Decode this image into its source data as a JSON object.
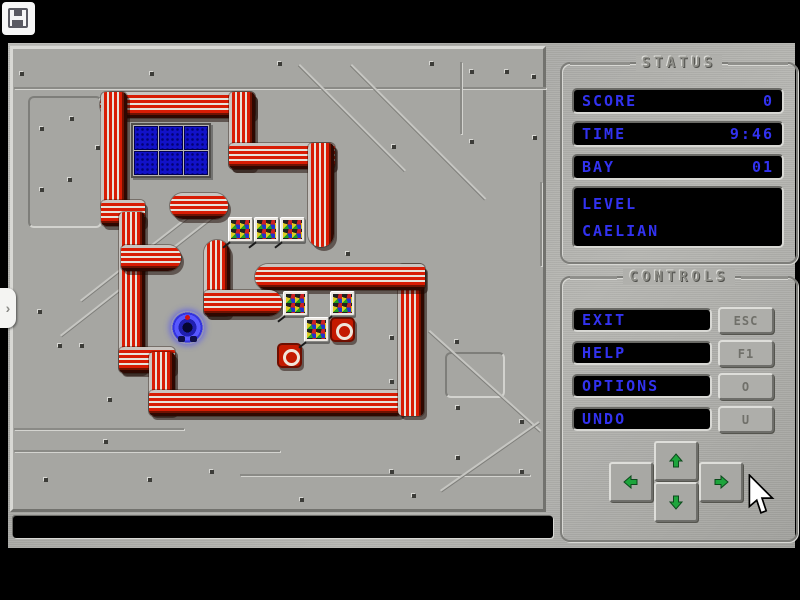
{
  "save_button": {
    "icon": "floppy-disk-icon"
  },
  "side_tab": {
    "chevron": "›"
  },
  "status_panel": {
    "title": "STATUS",
    "rows": [
      {
        "label": "SCORE",
        "value": "0"
      },
      {
        "label": "TIME",
        "value": "9:46"
      },
      {
        "label": "BAY",
        "value": "01"
      }
    ],
    "level_label": "LEVEL",
    "level_name": "CAELIAN"
  },
  "controls_panel": {
    "title": "CONTROLS",
    "buttons": [
      {
        "label": "EXIT",
        "key": "ESC"
      },
      {
        "label": "HELP",
        "key": "F1"
      },
      {
        "label": "OPTIONS",
        "key": "O"
      },
      {
        "label": "UNDO",
        "key": "U"
      }
    ],
    "dpad": [
      "up",
      "left",
      "down",
      "right"
    ]
  },
  "message_bar": {
    "text": ""
  },
  "colors": {
    "lcd_text": "#3232f0",
    "wall_red": "#d81c04",
    "arrow_green": "#1da53c",
    "water_blue": "#1212c8",
    "target_red": "#c41a00",
    "metal": "#b0b0ac"
  },
  "level": {
    "walls": [
      {
        "x": 100,
        "y": 92,
        "w": 155,
        "h": 26,
        "dir": "h",
        "cap": "left"
      },
      {
        "x": 229,
        "y": 92,
        "w": 26,
        "h": 77,
        "dir": "v",
        "cap": "none"
      },
      {
        "x": 229,
        "y": 143,
        "w": 106,
        "h": 26,
        "dir": "h",
        "cap": "none"
      },
      {
        "x": 308,
        "y": 143,
        "w": 26,
        "h": 104,
        "dir": "v",
        "cap": "bottom"
      },
      {
        "x": 101,
        "y": 92,
        "w": 26,
        "h": 120,
        "dir": "v",
        "cap": "none"
      },
      {
        "x": 101,
        "y": 200,
        "w": 44,
        "h": 26,
        "dir": "h",
        "cap": "none"
      },
      {
        "x": 119,
        "y": 212,
        "w": 26,
        "h": 160,
        "dir": "v",
        "cap": "none"
      },
      {
        "x": 121,
        "y": 245,
        "w": 60,
        "h": 26,
        "dir": "h",
        "cap": "right"
      },
      {
        "x": 119,
        "y": 347,
        "w": 56,
        "h": 26,
        "dir": "h",
        "cap": "none"
      },
      {
        "x": 149,
        "y": 352,
        "w": 26,
        "h": 62,
        "dir": "v",
        "cap": "none"
      },
      {
        "x": 149,
        "y": 390,
        "w": 253,
        "h": 26,
        "dir": "h",
        "cap": "none"
      },
      {
        "x": 398,
        "y": 264,
        "w": 26,
        "h": 152,
        "dir": "v",
        "cap": "none"
      },
      {
        "x": 255,
        "y": 264,
        "w": 170,
        "h": 26,
        "dir": "h",
        "cap": "left"
      },
      {
        "x": 204,
        "y": 240,
        "w": 26,
        "h": 76,
        "dir": "v",
        "cap": "top"
      },
      {
        "x": 204,
        "y": 290,
        "w": 78,
        "h": 26,
        "dir": "h",
        "cap": "right"
      },
      {
        "x": 170,
        "y": 193,
        "w": 58,
        "h": 26,
        "dir": "h",
        "cap": "both"
      }
    ],
    "water": {
      "x": 131,
      "y": 123,
      "cols": 3,
      "rows": 2,
      "size": 24
    },
    "crates": [
      [
        228,
        217
      ],
      [
        254,
        217
      ],
      [
        280,
        217
      ],
      [
        283,
        291
      ],
      [
        330,
        291
      ],
      [
        304,
        317
      ]
    ],
    "targets": [
      [
        330,
        317
      ],
      [
        277,
        343
      ]
    ],
    "player": {
      "x": 171,
      "y": 311
    },
    "decor": {
      "rivets": [
        [
          20,
          72
        ],
        [
          150,
          72
        ],
        [
          278,
          62
        ],
        [
          430,
          62
        ],
        [
          505,
          70
        ],
        [
          40,
          127
        ],
        [
          70,
          117
        ],
        [
          96,
          146
        ],
        [
          40,
          188
        ],
        [
          68,
          178
        ],
        [
          38,
          310
        ],
        [
          58,
          344
        ],
        [
          80,
          344
        ],
        [
          108,
          398
        ],
        [
          104,
          440
        ],
        [
          148,
          478
        ],
        [
          44,
          478
        ],
        [
          210,
          470
        ],
        [
          330,
          150
        ],
        [
          392,
          145
        ],
        [
          470,
          70
        ],
        [
          532,
          75
        ],
        [
          470,
          140
        ],
        [
          533,
          136
        ],
        [
          346,
          252
        ],
        [
          390,
          336
        ],
        [
          455,
          340
        ],
        [
          390,
          380
        ],
        [
          456,
          406
        ],
        [
          520,
          420
        ],
        [
          456,
          456
        ],
        [
          390,
          470
        ],
        [
          520,
          470
        ],
        [
          300,
          498
        ],
        [
          412,
          494
        ]
      ],
      "boxes": [
        [
          28,
          96,
          74,
          132
        ],
        [
          445,
          352,
          60,
          46
        ]
      ],
      "lines": [
        [
          14,
          87,
          532,
          2
        ],
        [
          14,
          428,
          170,
          2
        ],
        [
          14,
          450,
          266,
          2
        ],
        [
          240,
          474,
          290,
          2
        ],
        [
          460,
          62,
          2,
          72
        ],
        [
          540,
          182,
          2,
          84
        ]
      ],
      "diagonals": [
        {
          "x": 300,
          "y": 64,
          "len": 150,
          "a": 45
        },
        {
          "x": 352,
          "y": 64,
          "len": 190,
          "a": 45
        },
        {
          "x": 80,
          "y": 300,
          "len": 160,
          "a": -38
        },
        {
          "x": 60,
          "y": 335,
          "len": 200,
          "a": -38
        },
        {
          "x": 430,
          "y": 330,
          "len": 150,
          "a": 42
        },
        {
          "x": 440,
          "y": 490,
          "len": 120,
          "a": -35
        }
      ]
    }
  }
}
